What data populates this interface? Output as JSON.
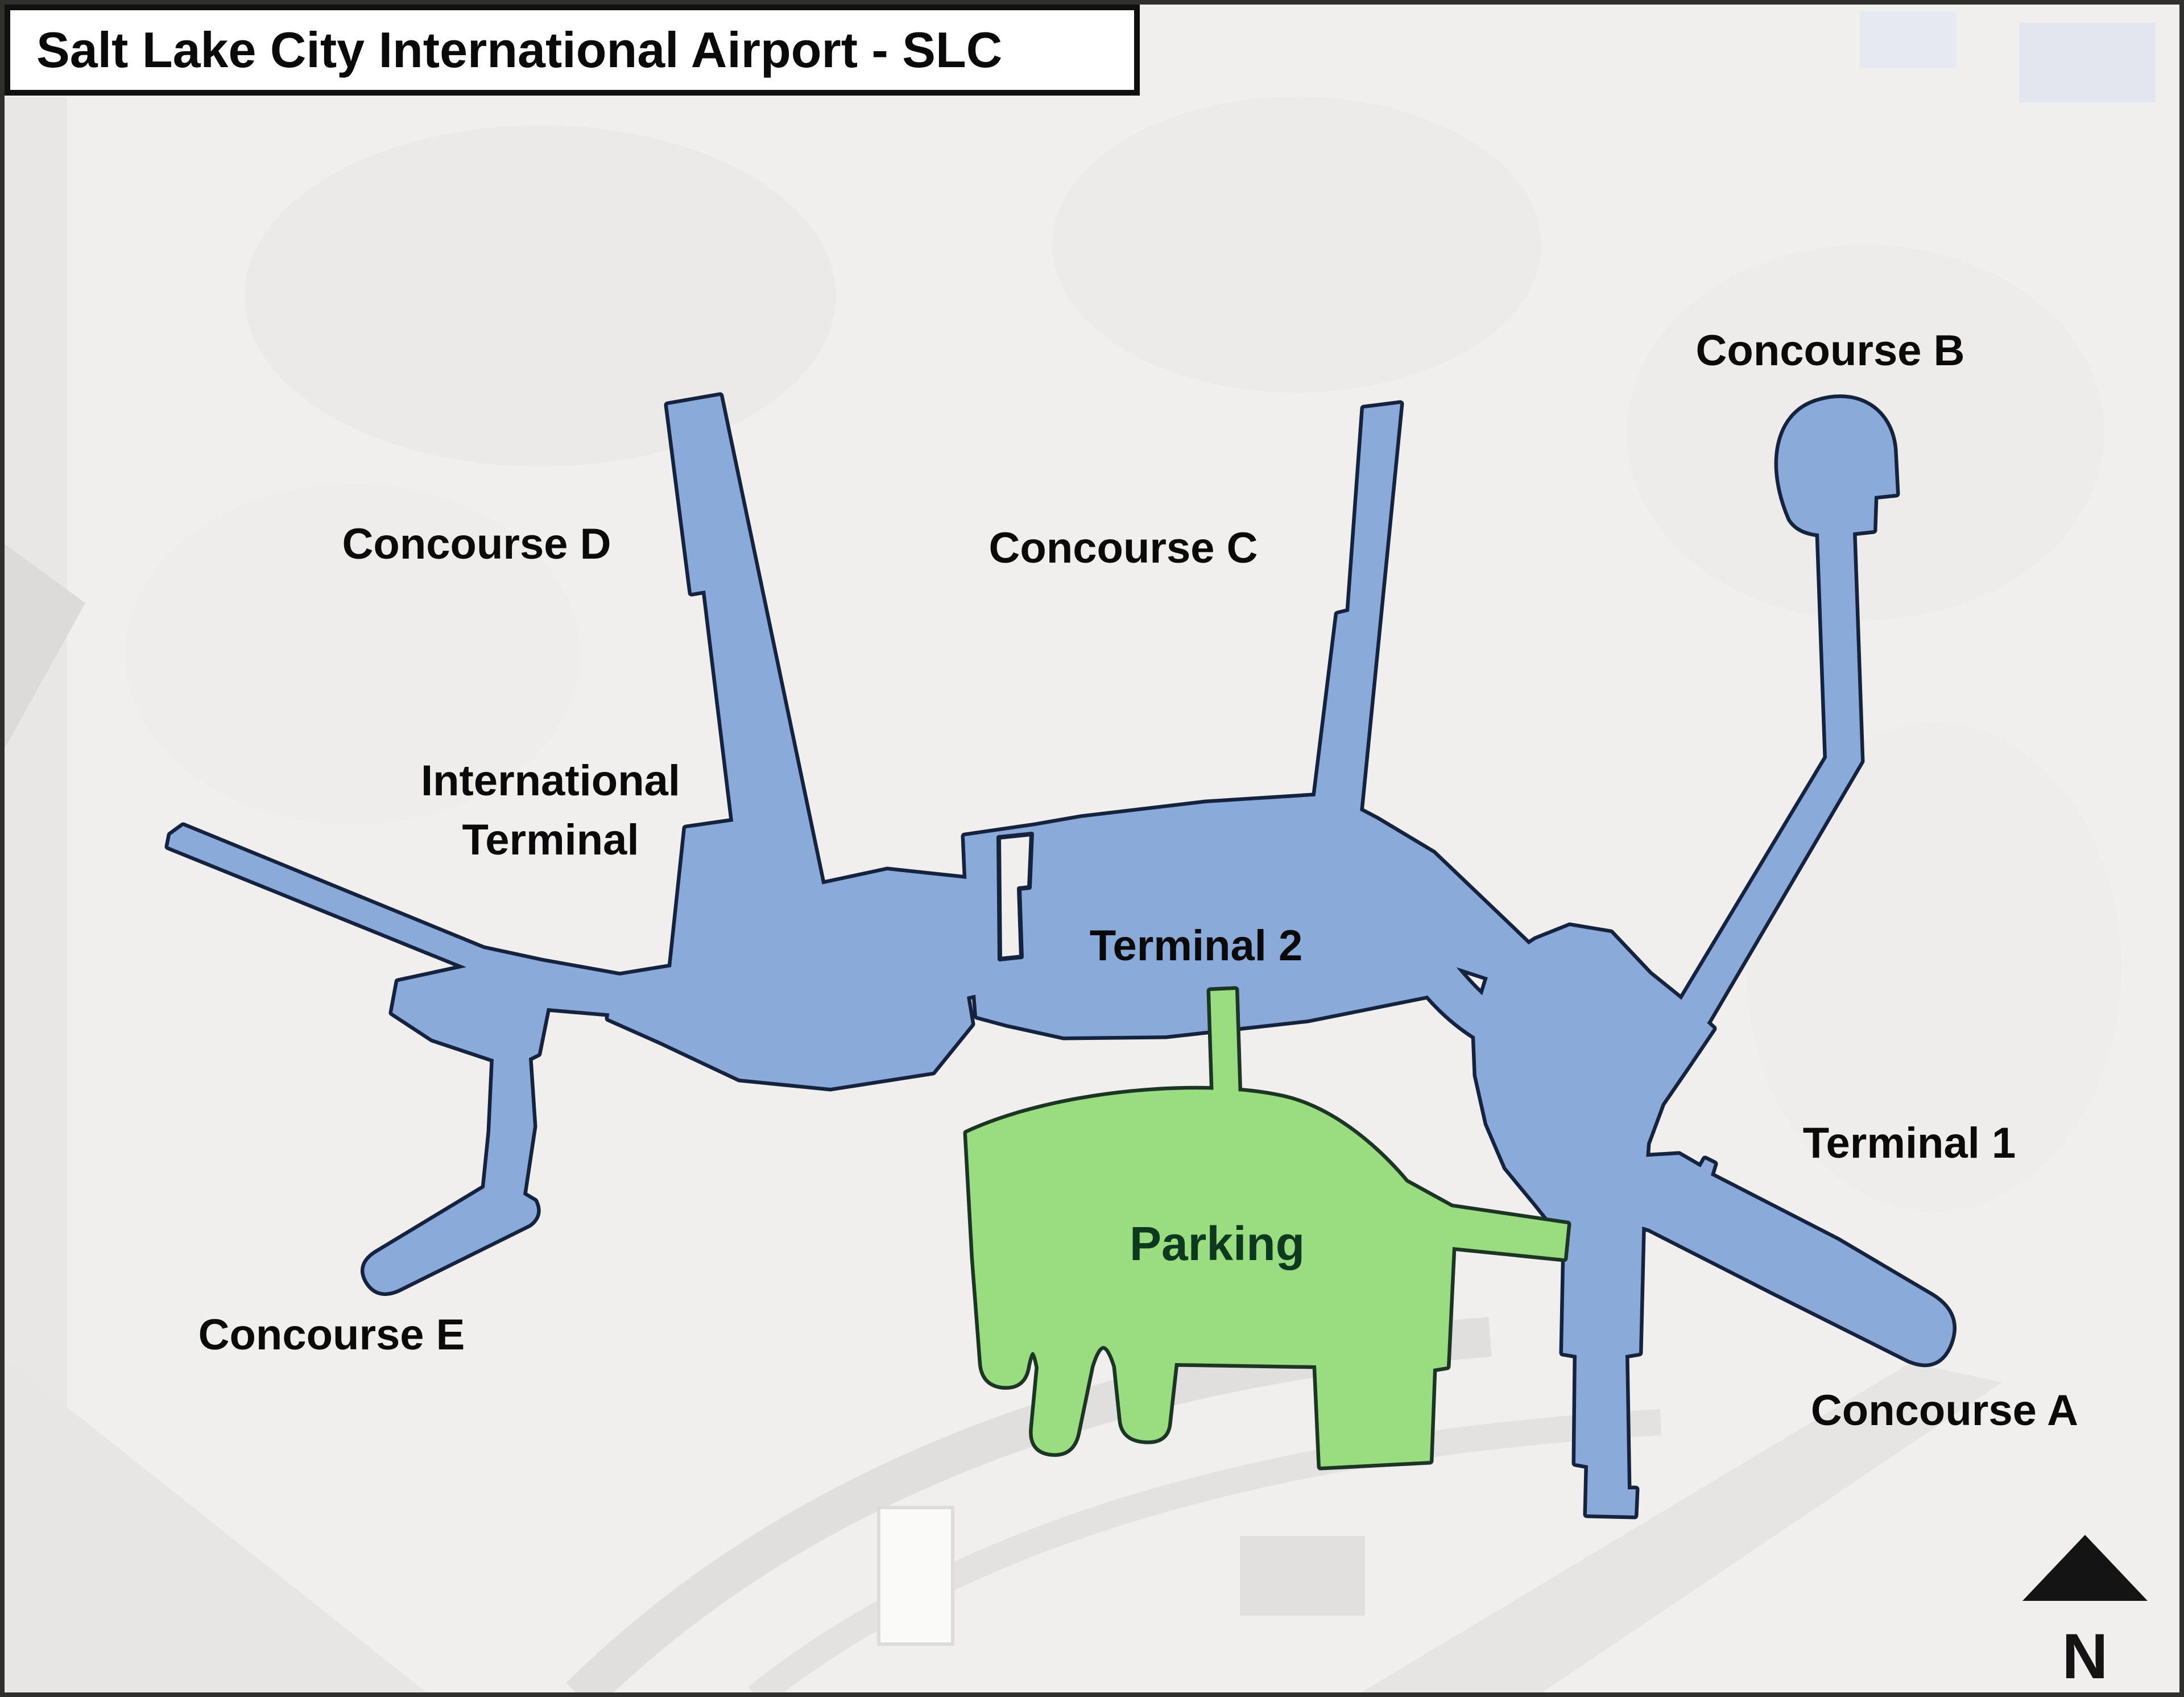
{
  "title": "Salt Lake City International Airport - SLC",
  "map": {
    "labels": {
      "concourse_b": "Concourse B",
      "concourse_c": "Concourse C",
      "concourse_d": "Concourse D",
      "concourse_e": "Concourse E",
      "concourse_a": "Concourse A",
      "international_terminal_line1": "International",
      "international_terminal_line2": "Terminal",
      "terminal_1": "Terminal 1",
      "terminal_2": "Terminal 2",
      "parking": "Parking"
    },
    "compass": {
      "label": "N"
    },
    "colors": {
      "background": "#f0efed",
      "terminal_fill": "#8aabda",
      "terminal_outline": "#16233f",
      "parking_fill": "#99dd80",
      "parking_outline": "#1c3524",
      "label_color": "#0a0a0a",
      "parking_label_color": "#0d3a1e"
    }
  }
}
